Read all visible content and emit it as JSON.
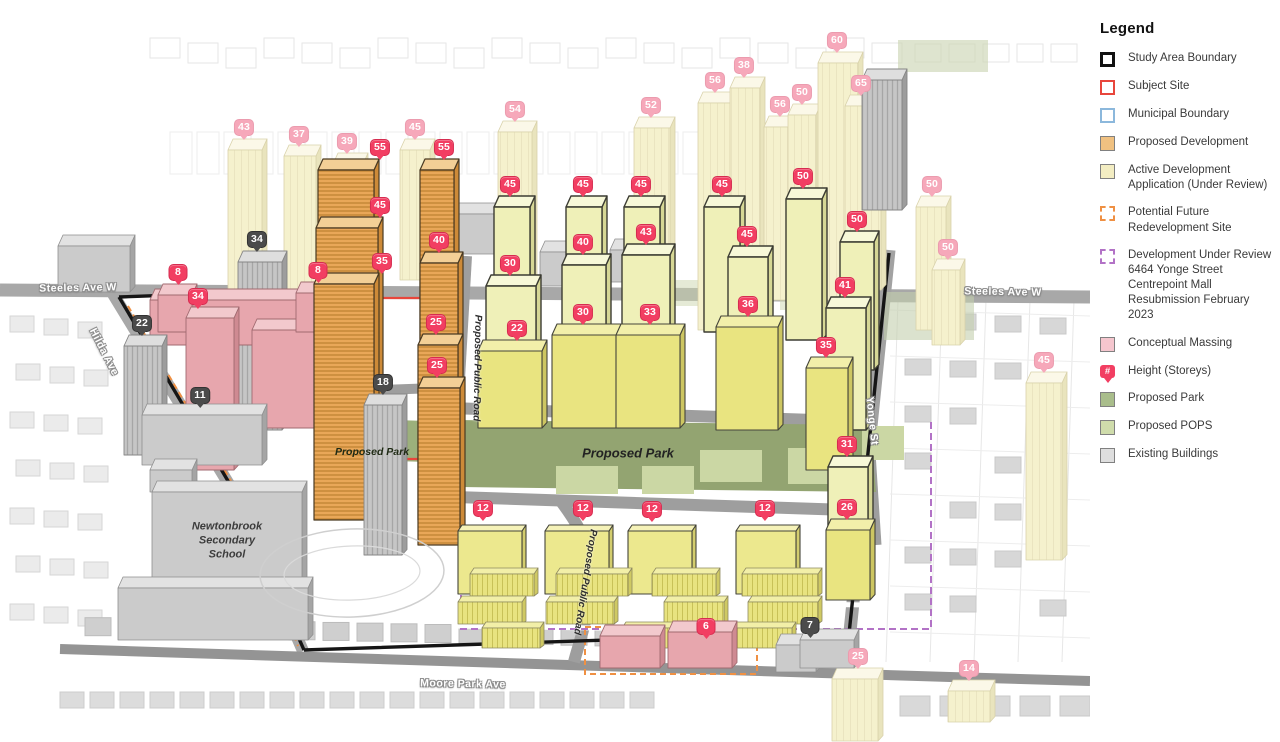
{
  "colors": {
    "pin_bright": "#f23e62",
    "pin_faded": "#f6a8ba",
    "pin_gray": "#4b4b4b",
    "proposed_development": "#f0c181",
    "active_application": "#f3edc2",
    "conceptual_massing": "#f5c6ce",
    "proposed_park": "#a9bd8b",
    "proposed_pops": "#cfdcab",
    "existing_buildings": "#dedede",
    "study_area_boundary": "#111111",
    "subject_site": "#e8463c",
    "municipal_boundary": "#8cb8dc",
    "future_redevelopment": "#ef9043",
    "under_review": "#b272c6"
  },
  "legend": {
    "title": "Legend",
    "items": [
      {
        "key": "study-area-boundary",
        "label": "Study Area Boundary",
        "swatch": "outline-thick",
        "color": "#111111"
      },
      {
        "key": "subject-site",
        "label": "Subject Site",
        "swatch": "outline",
        "color": "#e8463c"
      },
      {
        "key": "municipal-boundary",
        "label": "Municipal Boundary",
        "swatch": "outline",
        "color": "#8cb8dc"
      },
      {
        "key": "proposed-development",
        "label": "Proposed Development",
        "swatch": "fill",
        "color": "#f0c181"
      },
      {
        "key": "active-development-application",
        "label": "Active Development Application (Under Review)",
        "swatch": "fill",
        "color": "#f3edc2"
      },
      {
        "key": "potential-future-redevelopment-site",
        "label": "Potential Future Redevelopment Site",
        "swatch": "dashed",
        "color": "#ef9043"
      },
      {
        "key": "development-under-review",
        "label": "Development Under Review",
        "extra_lines": [
          "6464 Yonge Street",
          "Centrepoint Mall",
          "Resubmission February",
          "2023"
        ],
        "swatch": "dashed",
        "color": "#b272c6"
      },
      {
        "key": "conceptual-massing",
        "label": "Conceptual Massing",
        "swatch": "fill",
        "color": "#f5c6ce"
      },
      {
        "key": "height-storeys",
        "label": "Height (Storeys)",
        "swatch": "pin",
        "color": "#f23e62",
        "pin_glyph": "#"
      },
      {
        "key": "proposed-park",
        "label": "Proposed Park",
        "swatch": "fill",
        "color": "#a9bd8b"
      },
      {
        "key": "proposed-pops",
        "label": "Proposed POPS",
        "swatch": "fill",
        "color": "#cfdcab"
      },
      {
        "key": "existing-buildings",
        "label": "Existing Buildings",
        "swatch": "fill",
        "color": "#dedede"
      }
    ]
  },
  "map": {
    "road_labels": [
      {
        "text": "Steeles Ave W",
        "x": 78,
        "y": 288,
        "rot": -1,
        "style": "road"
      },
      {
        "text": "Steeles Ave W",
        "x": 1003,
        "y": 292,
        "rot": 1,
        "style": "road"
      },
      {
        "text": "Hilda Ave",
        "x": 104,
        "y": 352,
        "rot": 63,
        "style": "road"
      },
      {
        "text": "Yonge St",
        "x": 872,
        "y": 421,
        "rot": 84,
        "style": "road"
      },
      {
        "text": "Moore Park Ave",
        "x": 463,
        "y": 684,
        "rot": 1,
        "style": "road"
      },
      {
        "text": "Proposed Public Road",
        "x": 477,
        "y": 368,
        "rot": 91,
        "style": "road-dark"
      },
      {
        "text": "Proposed Public Road",
        "x": 585,
        "y": 582,
        "rot": 99,
        "style": "road-dark"
      }
    ],
    "area_labels": [
      {
        "text": "Proposed Park",
        "x": 628,
        "y": 453,
        "style": "park-lg"
      },
      {
        "text": "Proposed Park",
        "x": 372,
        "y": 452,
        "style": "park-sm"
      },
      {
        "text": "Newtonbrook\nSecondary\nSchool",
        "x": 227,
        "y": 541,
        "style": "school"
      }
    ],
    "pins": [
      {
        "v": "55",
        "x": 380,
        "y": 152,
        "kind": "bright"
      },
      {
        "v": "55",
        "x": 444,
        "y": 152,
        "kind": "bright"
      },
      {
        "v": "45",
        "x": 380,
        "y": 210,
        "kind": "bright"
      },
      {
        "v": "40",
        "x": 439,
        "y": 245,
        "kind": "bright"
      },
      {
        "v": "35",
        "x": 382,
        "y": 266,
        "kind": "bright"
      },
      {
        "v": "25",
        "x": 436,
        "y": 327,
        "kind": "bright"
      },
      {
        "v": "25",
        "x": 437,
        "y": 370,
        "kind": "bright"
      },
      {
        "v": "45",
        "x": 510,
        "y": 189,
        "kind": "bright"
      },
      {
        "v": "30",
        "x": 510,
        "y": 268,
        "kind": "bright"
      },
      {
        "v": "22",
        "x": 517,
        "y": 333,
        "kind": "bright"
      },
      {
        "v": "45",
        "x": 583,
        "y": 189,
        "kind": "bright"
      },
      {
        "v": "40",
        "x": 583,
        "y": 247,
        "kind": "bright"
      },
      {
        "v": "30",
        "x": 583,
        "y": 317,
        "kind": "bright"
      },
      {
        "v": "45",
        "x": 641,
        "y": 189,
        "kind": "bright"
      },
      {
        "v": "43",
        "x": 646,
        "y": 237,
        "kind": "bright"
      },
      {
        "v": "33",
        "x": 650,
        "y": 317,
        "kind": "bright"
      },
      {
        "v": "45",
        "x": 722,
        "y": 189,
        "kind": "bright"
      },
      {
        "v": "45",
        "x": 747,
        "y": 239,
        "kind": "bright"
      },
      {
        "v": "36",
        "x": 748,
        "y": 309,
        "kind": "bright"
      },
      {
        "v": "50",
        "x": 803,
        "y": 181,
        "kind": "bright"
      },
      {
        "v": "50",
        "x": 857,
        "y": 224,
        "kind": "bright"
      },
      {
        "v": "41",
        "x": 845,
        "y": 290,
        "kind": "bright"
      },
      {
        "v": "35",
        "x": 826,
        "y": 350,
        "kind": "bright"
      },
      {
        "v": "31",
        "x": 847,
        "y": 449,
        "kind": "bright"
      },
      {
        "v": "26",
        "x": 847,
        "y": 512,
        "kind": "bright"
      },
      {
        "v": "12",
        "x": 483,
        "y": 513,
        "kind": "bright"
      },
      {
        "v": "12",
        "x": 583,
        "y": 513,
        "kind": "bright"
      },
      {
        "v": "12",
        "x": 652,
        "y": 514,
        "kind": "bright"
      },
      {
        "v": "12",
        "x": 765,
        "y": 513,
        "kind": "bright"
      },
      {
        "v": "6",
        "x": 706,
        "y": 631,
        "kind": "bright"
      },
      {
        "v": "8",
        "x": 178,
        "y": 277,
        "kind": "bright"
      },
      {
        "v": "34",
        "x": 198,
        "y": 301,
        "kind": "bright"
      },
      {
        "v": "8",
        "x": 318,
        "y": 275,
        "kind": "bright"
      },
      {
        "v": "43",
        "x": 244,
        "y": 132,
        "kind": "faded"
      },
      {
        "v": "37",
        "x": 299,
        "y": 139,
        "kind": "faded"
      },
      {
        "v": "39",
        "x": 347,
        "y": 146,
        "kind": "faded"
      },
      {
        "v": "45",
        "x": 415,
        "y": 132,
        "kind": "faded"
      },
      {
        "v": "54",
        "x": 515,
        "y": 114,
        "kind": "faded"
      },
      {
        "v": "52",
        "x": 651,
        "y": 110,
        "kind": "faded"
      },
      {
        "v": "56",
        "x": 715,
        "y": 85,
        "kind": "faded"
      },
      {
        "v": "38",
        "x": 744,
        "y": 70,
        "kind": "faded"
      },
      {
        "v": "60",
        "x": 837,
        "y": 45,
        "kind": "faded"
      },
      {
        "v": "50",
        "x": 802,
        "y": 97,
        "kind": "faded"
      },
      {
        "v": "56",
        "x": 780,
        "y": 109,
        "kind": "faded"
      },
      {
        "v": "65",
        "x": 861,
        "y": 88,
        "kind": "faded"
      },
      {
        "v": "50",
        "x": 932,
        "y": 189,
        "kind": "faded"
      },
      {
        "v": "50",
        "x": 948,
        "y": 252,
        "kind": "faded"
      },
      {
        "v": "45",
        "x": 1044,
        "y": 365,
        "kind": "faded"
      },
      {
        "v": "25",
        "x": 858,
        "y": 661,
        "kind": "faded"
      },
      {
        "v": "14",
        "x": 969,
        "y": 673,
        "kind": "faded"
      },
      {
        "v": "34",
        "x": 257,
        "y": 244,
        "kind": "gray"
      },
      {
        "v": "22",
        "x": 142,
        "y": 328,
        "kind": "gray"
      },
      {
        "v": "11",
        "x": 200,
        "y": 400,
        "kind": "gray"
      },
      {
        "v": "18",
        "x": 383,
        "y": 387,
        "kind": "gray"
      },
      {
        "v": "7",
        "x": 810,
        "y": 630,
        "kind": "gray"
      }
    ]
  }
}
